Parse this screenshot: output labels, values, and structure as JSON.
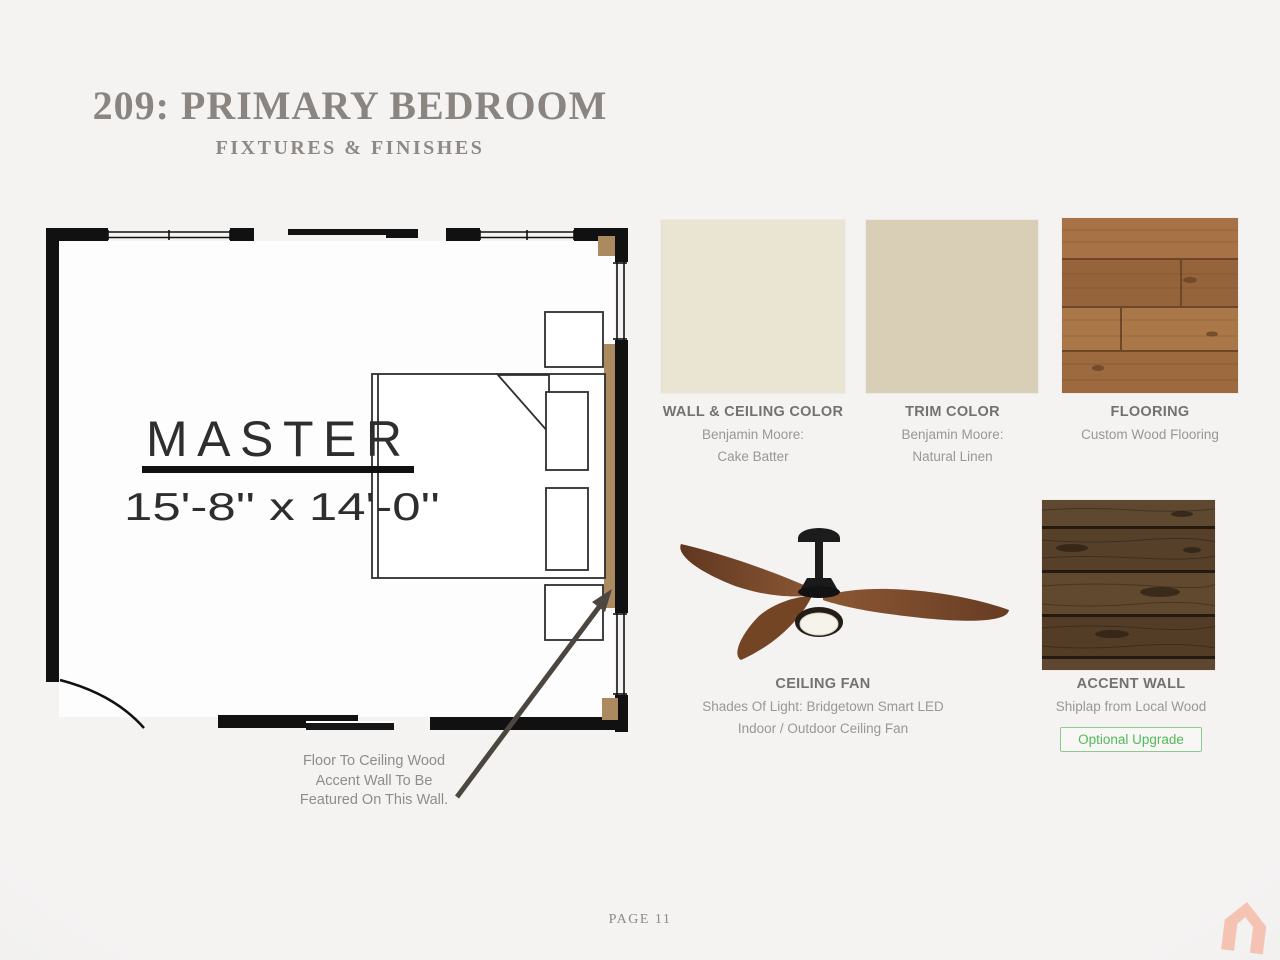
{
  "header": {
    "title": "209: PRIMARY BEDROOM",
    "subtitle": "FIXTURES & FINISHES"
  },
  "floor_plan": {
    "room_label": "MASTER",
    "room_dimensions": "15'-8'' x 14'-0''",
    "annotation_line1": "Floor To Ceiling Wood",
    "annotation_line2": "Accent Wall To Be",
    "annotation_line3": "Featured On This Wall."
  },
  "finishes": [
    {
      "title": "WALL & CEILING COLOR",
      "line1": "Benjamin Moore:",
      "line2": "Cake Batter",
      "swatch_color": "#EAE5D2"
    },
    {
      "title": "TRIM COLOR",
      "line1": "Benjamin Moore:",
      "line2": "Natural Linen",
      "swatch_color": "#D8CFB6"
    },
    {
      "title": "FLOORING",
      "line1": "Custom Wood Flooring",
      "swatch_color": "#9E6B3F"
    },
    {
      "title": "CEILING FAN",
      "line1": "Shades Of Light: Bridgetown Smart LED",
      "line2": "Indoor / Outdoor Ceiling Fan"
    },
    {
      "title": "ACCENT WALL",
      "line1": "Shiplap from Local Wood",
      "badge": "Optional Upgrade",
      "swatch_color": "#5B432C"
    }
  ],
  "footer": {
    "page_label": "PAGE 11"
  },
  "colors": {
    "background": "#F2F1F0",
    "title_text": "#8A8580",
    "label_bold": "#74726F",
    "label_sub": "#9A9793",
    "badge_green": "#52BA58",
    "badge_border": "#8CCB8F",
    "accent_wood_strip": "#AB8A60",
    "arrow": "#4B463F",
    "logo_salmon": "#F5BBA8"
  }
}
